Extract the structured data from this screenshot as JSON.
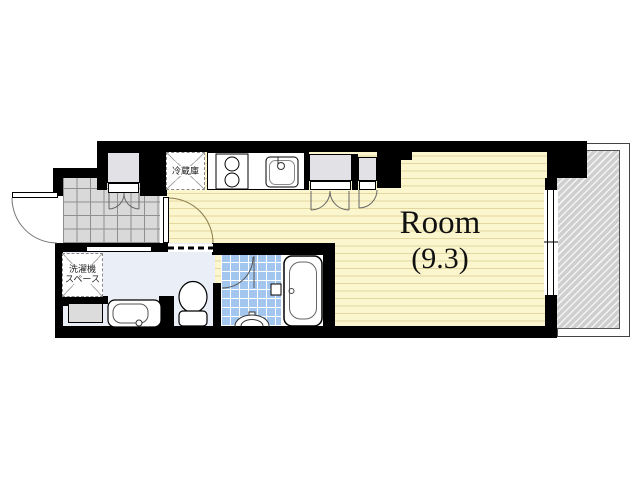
{
  "plan": {
    "room": {
      "name": "Room",
      "size_label": "(9.3)"
    },
    "labels": {
      "refrigerator": "冷蔵庫",
      "washer_space": [
        "洗濯機",
        "スペース"
      ]
    },
    "colors": {
      "wall": "#000000",
      "room_floor": "#FBF6CE",
      "entrance_tile": "#D9D9D9",
      "bath_tile": "#A3C6EE",
      "washroom_floor": "#E9EEF7",
      "closet_fill": "#E2E2E6",
      "balcony_hatch": "#CFCFCF"
    }
  }
}
